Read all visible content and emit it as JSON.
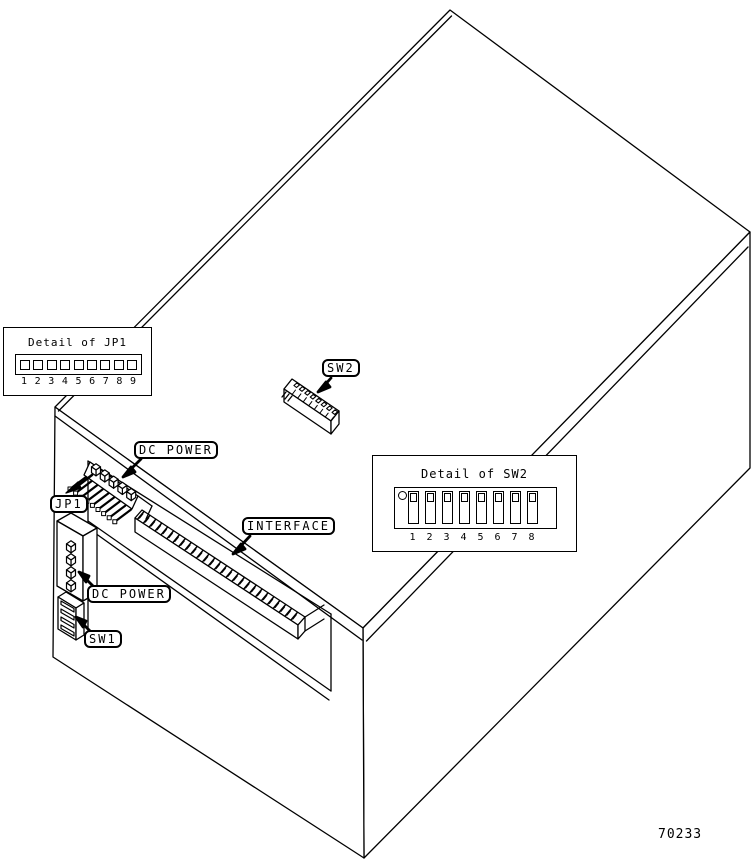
{
  "figure": {
    "part_number": "70233",
    "callouts": {
      "dc_power_top": "DC POWER",
      "jp1": "JP1",
      "dc_power_left": "DC POWER",
      "sw1": "SW1",
      "sw2": "SW2",
      "interface": "INTERFACE"
    },
    "detail_jp1": {
      "title": "Detail of JP1",
      "pins": [
        "1",
        "2",
        "3",
        "4",
        "5",
        "6",
        "7",
        "8",
        "9"
      ]
    },
    "detail_sw2": {
      "title": "Detail of SW2",
      "switches": [
        "1",
        "2",
        "3",
        "4",
        "5",
        "6",
        "7",
        "8"
      ]
    },
    "line_color": "#000000",
    "background_color": "#ffffff"
  }
}
